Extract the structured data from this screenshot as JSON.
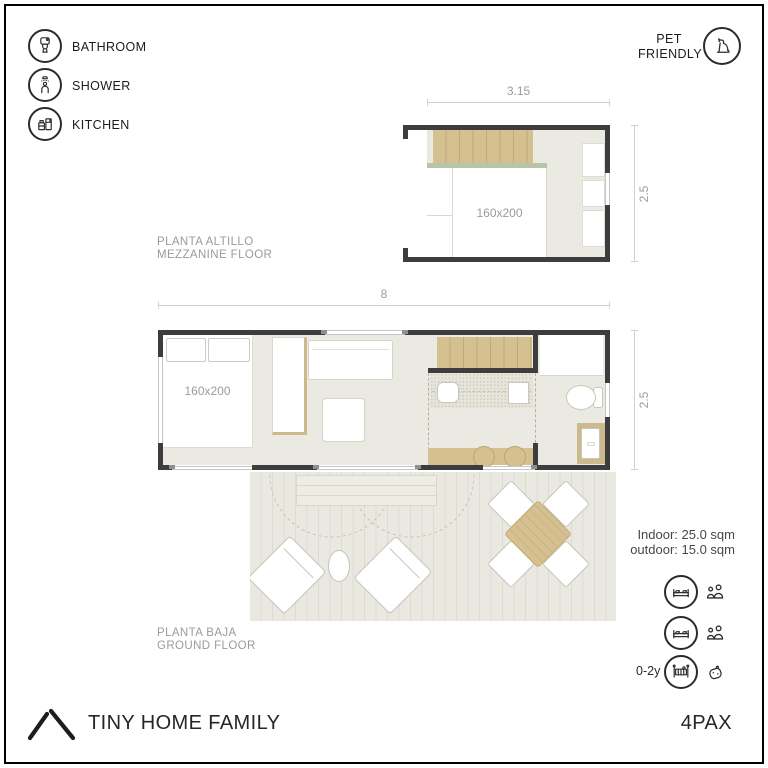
{
  "sheet": {
    "legend": {
      "items": [
        {
          "icon": "toilet-icon",
          "label": "BATHROOM"
        },
        {
          "icon": "shower-icon",
          "label": "SHOWER"
        },
        {
          "icon": "kitchen-icon",
          "label": "KITCHEN"
        }
      ]
    },
    "pet_badge": {
      "line1": "PET",
      "line2": "FRIENDLY",
      "icon": "dog-icon"
    },
    "plans": {
      "mezzanine": {
        "title_es": "PLANTA ALTILLO",
        "title_en": "MEZZANINE FLOOR",
        "dim_width": "3.15",
        "dim_height": "2.5",
        "bed_size": "160x200"
      },
      "ground": {
        "title_es": "PLANTA BAJA",
        "title_en": "GROUND FLOOR",
        "dim_width": "8",
        "dim_height": "2.5",
        "bed_size": "160x200"
      }
    },
    "areas": {
      "indoor": "Indoor: 25.0 sqm",
      "outdoor": "outdoor: 15.0 sqm"
    },
    "occupancy": [
      {
        "age_label": "",
        "bed_icon": "double-bed-icon",
        "guest_icon": "two-adults-icon"
      },
      {
        "age_label": "",
        "bed_icon": "double-bed-icon",
        "guest_icon": "two-adults-icon"
      },
      {
        "age_label": "0-2y",
        "bed_icon": "baby-crib-icon",
        "guest_icon": "baby-icon"
      }
    ],
    "footer": {
      "brand": "TINY HOME FAMILY",
      "capacity": "4PAX"
    },
    "colors": {
      "wall": "#3d3d3d",
      "wood": "#d5c08f",
      "rail_green": "#b6c5a7",
      "floor_indoor": "#eae9e2",
      "deck": "#e9e8e1",
      "dim_text": "#9b9b9b",
      "ink": "#2b2b2b"
    }
  }
}
